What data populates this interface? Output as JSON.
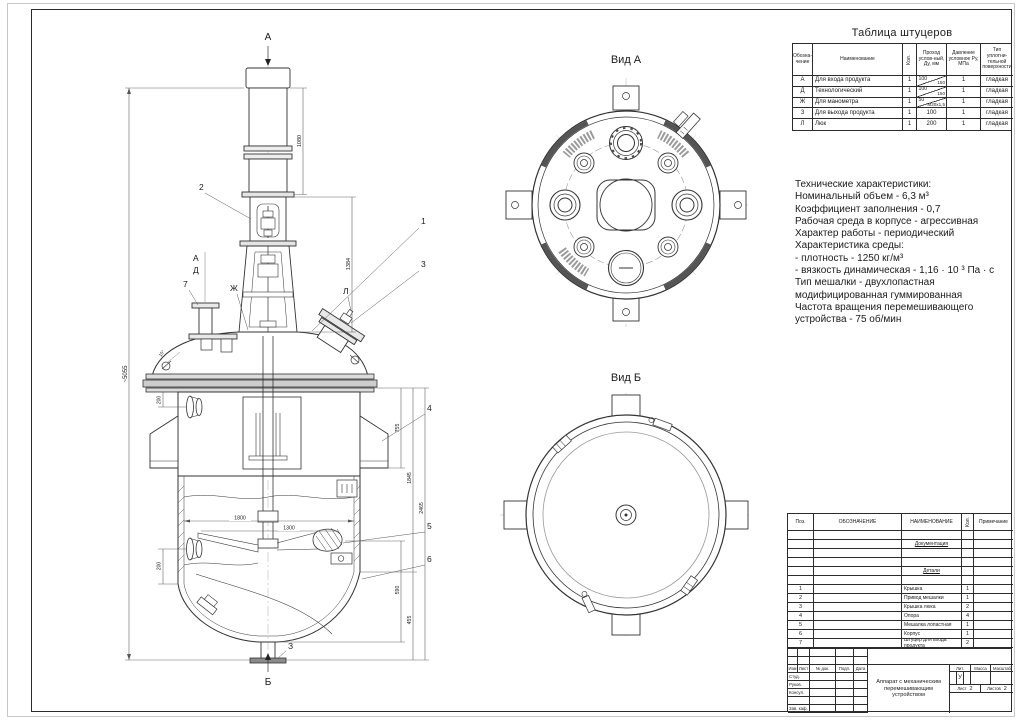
{
  "views": {
    "a_title": "Вид А",
    "b_title": "Вид Б"
  },
  "front_view": {
    "view_arrow_top": "А",
    "view_arrow_bottom": "Б",
    "dim_motor": "1080",
    "dim_lantern": "1384",
    "dim_total": "~5055",
    "dim_755": "755",
    "dim_1845": "1845",
    "dim_2465": "2465",
    "dim_590": "590",
    "dim_455": "455",
    "dim_200_upper": "200",
    "dim_200_lower": "200",
    "dim_1800": "1800",
    "dim_1300": "1300",
    "angle": "15°",
    "pos1": "1",
    "pos2": "2",
    "pos3": "3",
    "pos4": "4",
    "pos5": "5",
    "pos6": "6",
    "pos7": "7",
    "noz_a": "А",
    "noz_d": "Д",
    "noz_zh": "Ж",
    "noz_l": "Л",
    "noz_z": "З"
  },
  "nozzle_table": {
    "title": "Таблица штуцеров",
    "col_mark": "Обозна-чение",
    "col_name": "Наименование",
    "col_qty": "Кол.",
    "col_dn": "Проход услов-ный, Ду, мм",
    "col_p": "Давление условное Ру, МПа",
    "col_surf": "Тип уплотни- тельной поверхности",
    "rows": [
      {
        "mark": "А",
        "name": "Для входа продукта",
        "qty": "1",
        "dn_top": "100",
        "dn_bot": "150",
        "p": "1",
        "surf": "гладкая"
      },
      {
        "mark": "Д",
        "name": "Технологический",
        "qty": "1",
        "dn_top": "100",
        "dn_bot": "150",
        "p": "1",
        "surf": "гладкая"
      },
      {
        "mark": "Ж",
        "name": "Для манометра",
        "qty": "1",
        "dn_top": "50",
        "dn_bot": "М20х1,5",
        "p": "1",
        "surf": "гладкая"
      },
      {
        "mark": "З",
        "name": "Для выхода продукта",
        "qty": "1",
        "dn": "100",
        "p": "1",
        "surf": "гладкая"
      },
      {
        "mark": "Л",
        "name": "Люк",
        "qty": "1",
        "dn": "200",
        "p": "1",
        "surf": "гладкая"
      }
    ]
  },
  "tech": {
    "lines": [
      "Технические характеристики:",
      "Номинальный объем - 6,3 м³",
      "Коэффициент заполнения - 0,7",
      "Рабочая среда в корпусе - агрессивная",
      "Характер работы - периодический",
      "Характеристика среды:",
      "- плотность - 1250 кг/м³",
      "- вязкость динамическая - 1,16 · 10 ³ Па · с",
      "Тип мешалки - двухлопастная",
      "модифицированная гуммированная",
      "Частота вращения перемешивающего",
      "устройства - 75 об/мин"
    ]
  },
  "spec_table": {
    "col_pos": "Поз.",
    "col_designation": "ОБОЗНАЧЕНИЕ",
    "col_name": "НАИМЕНОВАНИЕ",
    "col_qty": "Кол.",
    "col_note": "Примечание",
    "rows": [
      {
        "pos": "",
        "name": "",
        "qty": ""
      },
      {
        "pos": "",
        "name": "Документация",
        "qty": ""
      },
      {
        "pos": "",
        "name": "",
        "qty": ""
      },
      {
        "pos": "",
        "name": "",
        "qty": ""
      },
      {
        "pos": "",
        "name": "Детали",
        "qty": ""
      },
      {
        "pos": "",
        "name": "",
        "qty": ""
      },
      {
        "pos": "1",
        "name": "Крышка",
        "qty": "1"
      },
      {
        "pos": "2",
        "name": "Привод мешалки",
        "qty": "1"
      },
      {
        "pos": "3",
        "name": "Крышка люка",
        "qty": "2"
      },
      {
        "pos": "4",
        "name": "Опора",
        "qty": "4"
      },
      {
        "pos": "5",
        "name": "Мешалка лопастная",
        "qty": "1"
      },
      {
        "pos": "6",
        "name": "Корпус",
        "qty": "1"
      },
      {
        "pos": "7",
        "name": "Штуцер для входа продукта",
        "qty": "2"
      }
    ]
  },
  "title_block": {
    "col_izm": "Изм",
    "col_list": "Лист",
    "col_doc": "№ док.",
    "col_podp": "Подп.",
    "col_data": "Дата",
    "row_stud": "Студ.",
    "row_rukov": "Руков.",
    "row_konsul": "Консул.",
    "row_zav": "Зав. каф.",
    "doc_title": "Аппарат с механическим перемешивающим устройством",
    "lit_label": "Лит.",
    "lit_value": "У",
    "mass_label": "Масса",
    "scale_label": "Масштаб",
    "sheet_label": "Лист",
    "sheet_num": "2",
    "sheets_label": "Листов",
    "sheets_num": "2"
  }
}
